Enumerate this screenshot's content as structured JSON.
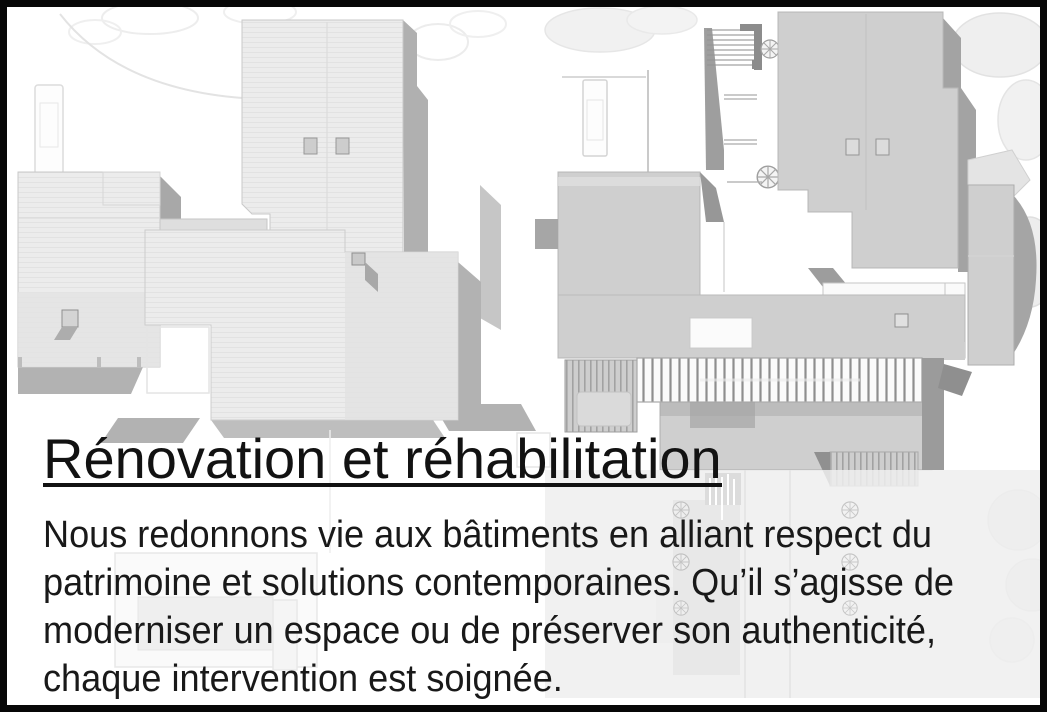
{
  "frame": {
    "border_color": "#070707",
    "background_color": "#ffffff"
  },
  "content": {
    "heading": "Rénovation et réhabilitation",
    "heading_color": "#121212",
    "paragraph_color": "#191919",
    "paragraph_lines": [
      "Nous redonnons vie aux bâtiments en alliant respect du",
      "patrimoine et solutions contemporaines. Qu’il s’agisse de",
      "moderniser un espace ou de préserver son authenticité,",
      "chaque intervention est soignée."
    ]
  },
  "figures": {
    "left_plan": "architectural-roof-plan-light",
    "right_plan": "architectural-roof-plan-hatched",
    "plan_fill": "#ececec",
    "plan_shadow": "#aeaeae",
    "hatch_fill": "#d7d7d7",
    "pergola_stripe": "#8f8f8f"
  }
}
